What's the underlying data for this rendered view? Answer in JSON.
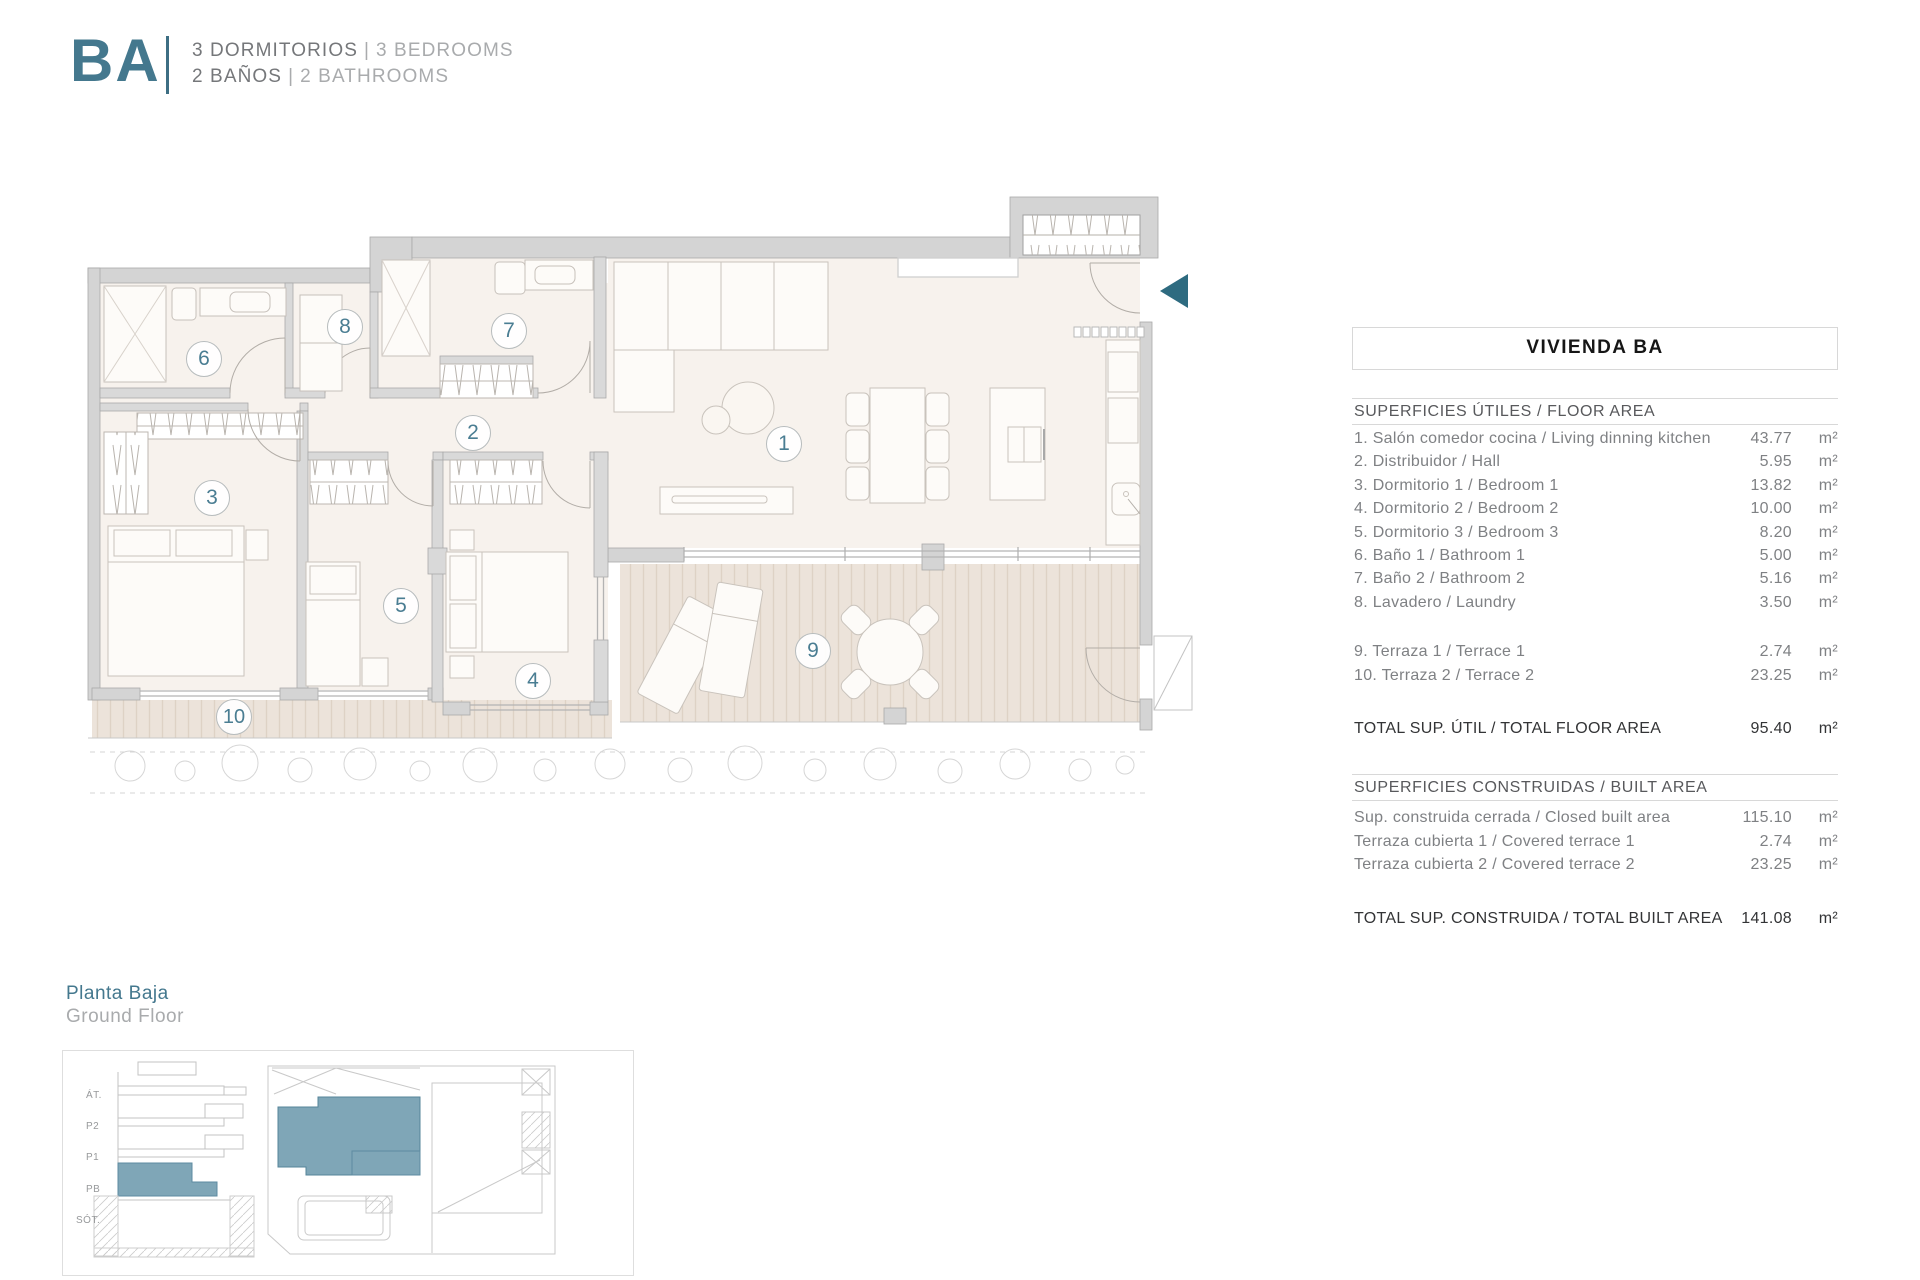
{
  "header": {
    "code": "BA",
    "line1": {
      "primary": "3 DORMITORIOS",
      "separator": "|",
      "secondary": "3 BEDROOMS"
    },
    "line2": {
      "primary": "2 BAÑOS",
      "separator": "|",
      "secondary": "2 BATHROOMS"
    }
  },
  "floor_plan": {
    "rooms": [
      {
        "num": "1",
        "name": "living-dining-kitchen"
      },
      {
        "num": "2",
        "name": "hall"
      },
      {
        "num": "3",
        "name": "bedroom-1"
      },
      {
        "num": "4",
        "name": "bedroom-2"
      },
      {
        "num": "5",
        "name": "bedroom-3"
      },
      {
        "num": "6",
        "name": "bathroom-1"
      },
      {
        "num": "7",
        "name": "bathroom-2"
      },
      {
        "num": "8",
        "name": "laundry"
      },
      {
        "num": "9",
        "name": "terrace-1"
      },
      {
        "num": "10",
        "name": "terrace-2"
      }
    ]
  },
  "floor_label": {
    "primary": "Planta Baja",
    "secondary": "Ground Floor"
  },
  "section_diagram": {
    "labels": [
      "ÁT.",
      "P2",
      "P1",
      "PB",
      "SÓT."
    ]
  },
  "area_table": {
    "title": "VIVIENDA BA",
    "floor_area_header": "SUPERFICIES ÚTILES / FLOOR AREA",
    "rows": [
      {
        "label": "1. Salón comedor cocina / Living dinning kitchen",
        "value": "43.77",
        "unit": "m²"
      },
      {
        "label": "2. Distribuidor / Hall",
        "value": "5.95",
        "unit": "m²"
      },
      {
        "label": "3. Dormitorio 1 / Bedroom 1",
        "value": "13.82",
        "unit": "m²"
      },
      {
        "label": "4. Dormitorio 2 / Bedroom 2",
        "value": "10.00",
        "unit": "m²"
      },
      {
        "label": "5. Dormitorio 3 / Bedroom 3",
        "value": "8.20",
        "unit": "m²"
      },
      {
        "label": "6. Baño 1 / Bathroom 1",
        "value": "5.00",
        "unit": "m²"
      },
      {
        "label": "7. Baño 2 / Bathroom 2",
        "value": "5.16",
        "unit": "m²"
      },
      {
        "label": "8. Lavadero / Laundry",
        "value": "3.50",
        "unit": "m²"
      }
    ],
    "terrace_rows": [
      {
        "label": "9. Terraza 1 / Terrace 1",
        "value": "2.74",
        "unit": "m²"
      },
      {
        "label": "10. Terraza 2 / Terrace 2",
        "value": "23.25",
        "unit": "m²"
      }
    ],
    "total_floor": {
      "label": "TOTAL SUP. ÚTIL / TOTAL FLOOR AREA",
      "value": "95.40",
      "unit": "m²"
    },
    "built_area_header": "SUPERFICIES CONSTRUIDAS / BUILT AREA",
    "built_rows": [
      {
        "label": "Sup. construida cerrada / Closed built area",
        "value": "115.10",
        "unit": "m²"
      },
      {
        "label": "Terraza cubierta 1 / Covered terrace 1",
        "value": "2.74",
        "unit": "m²"
      },
      {
        "label": "Terraza cubierta 2 / Covered terrace 2",
        "value": "23.25",
        "unit": "m²"
      }
    ],
    "total_built": {
      "label": "TOTAL SUP. CONSTRUIDA /  TOTAL BUILT AREA",
      "value": "141.08",
      "unit": "m²"
    }
  },
  "colors": {
    "accent": "#44788e",
    "accent_dark": "#2e6b80",
    "site_highlight": "#7fa6b7"
  }
}
